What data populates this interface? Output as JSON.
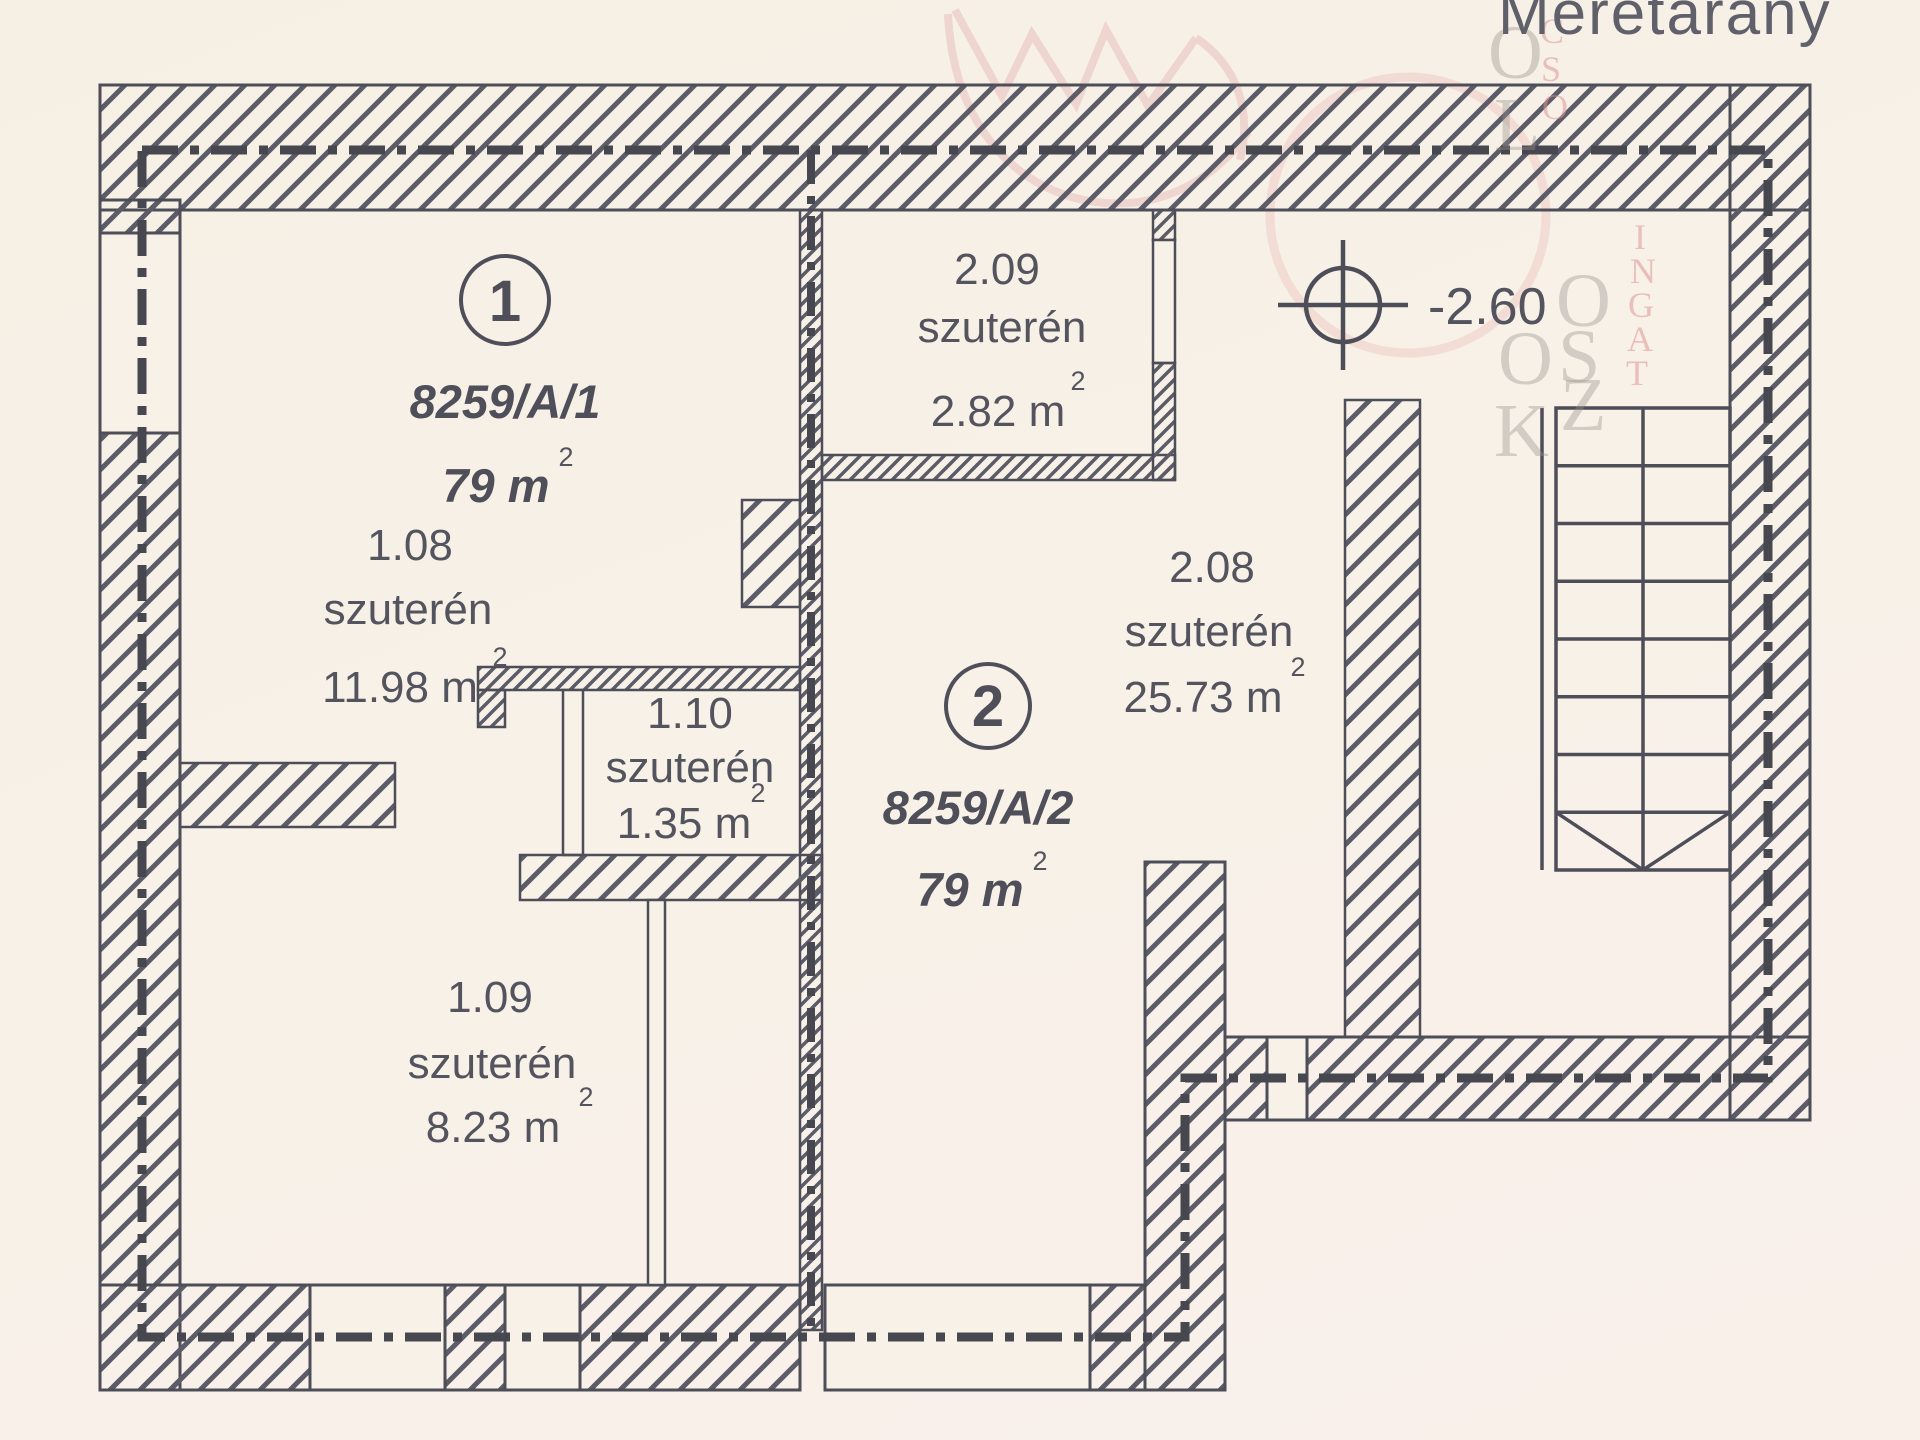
{
  "title": {
    "scale_label": "Méretarány"
  },
  "level": {
    "value": "-2.60"
  },
  "sup2": "2",
  "units": [
    {
      "number": "1",
      "plot": "8259/A/1",
      "area": "79 m"
    },
    {
      "number": "2",
      "plot": "8259/A/2",
      "area": "79 m"
    }
  ],
  "rooms": [
    {
      "code": "1.08",
      "type": "szuterén",
      "area": "11.98 m"
    },
    {
      "code": "1.09",
      "type": "szuterén",
      "area": "8.23 m"
    },
    {
      "code": "1.10",
      "type": "szuterén",
      "area": "1.35 m"
    },
    {
      "code": "2.08",
      "type": "szuterén",
      "area": "25.73 m"
    },
    {
      "code": "2.09",
      "type": "szuterén",
      "area": "2.82 m"
    }
  ],
  "watermark": {
    "gray_letters": [
      {
        "ch": "O",
        "x": 1488,
        "y": 10
      },
      {
        "ch": "L",
        "x": 1494,
        "y": 82
      },
      {
        "ch": "O",
        "x": 1556,
        "y": 258
      },
      {
        "ch": "S",
        "x": 1558,
        "y": 314
      },
      {
        "ch": "Z",
        "x": 1560,
        "y": 362
      },
      {
        "ch": "O",
        "x": 1498,
        "y": 316
      },
      {
        "ch": "K",
        "x": 1494,
        "y": 388
      }
    ],
    "pink_letters": [
      {
        "ch": "C",
        "x": 1540,
        "y": 10
      },
      {
        "ch": "S",
        "x": 1541,
        "y": 48
      },
      {
        "ch": "O",
        "x": 1542,
        "y": 86
      },
      {
        "ch": "I",
        "x": 1634,
        "y": 216
      },
      {
        "ch": "N",
        "x": 1630,
        "y": 250
      },
      {
        "ch": "G",
        "x": 1628,
        "y": 284
      },
      {
        "ch": "A",
        "x": 1627,
        "y": 318
      },
      {
        "ch": "T",
        "x": 1626,
        "y": 352
      }
    ]
  },
  "colors": {
    "paper": "#f7f1e8",
    "ink": "#4e4e59",
    "hatch": "#5c5c68",
    "text": "#54545e",
    "watermark_pink": "#ecc4c0",
    "watermark_gray": "#96918a"
  }
}
